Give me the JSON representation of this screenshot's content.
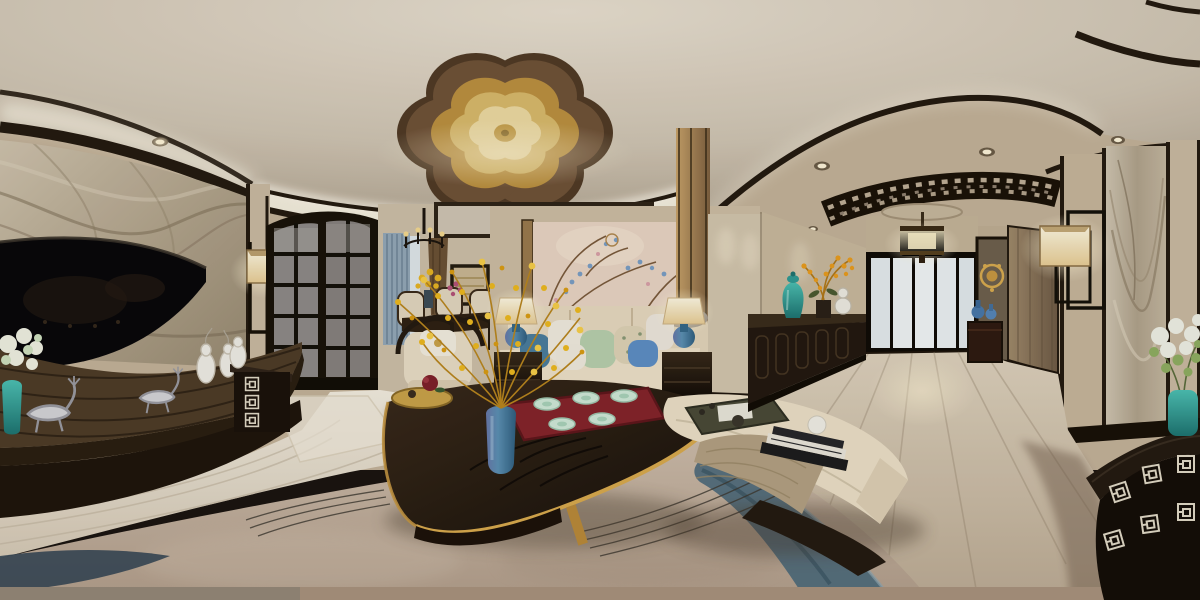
{
  "scene": {
    "type": "photograph",
    "projection": "equirectangular-360-panorama",
    "caption": "360-degree panoramic render of a luxury new-Chinese style living room, dining nook and entry hallway",
    "regions": [
      {
        "name": "tv-feature-wall",
        "description": "beige veined marble wall with large flat TV over a dark zebra-wood media console"
      },
      {
        "name": "living-area",
        "description": "cream sofa with pillows under a gold plum-blossom crystal chandelier, dark boat-shaped coffee table with yellow flowers and red tea tray"
      },
      {
        "name": "dining-nook",
        "description": "dark wood dining set with cream chairs, striped blue-grey curtains and small black chandelier"
      },
      {
        "name": "hallway",
        "description": "light wood floor corridor with black sideboard, frosted glass sliding doors, drum pendant and carved lattice ceiling band"
      },
      {
        "name": "right-wall",
        "description": "fabric wall panels, rectangular wall sconce, marble panel and black console with white fret pattern"
      }
    ],
    "objects": [
      {
        "name": "plum-blossom-chandelier",
        "color": "#c9a045"
      },
      {
        "name": "ceiling-cove-lighting",
        "color": "#f7f1e4"
      },
      {
        "name": "recessed-spotlights",
        "color": "#f4ead2"
      },
      {
        "name": "marble-feature-wall",
        "color": "#b9ab94"
      },
      {
        "name": "flat-tv",
        "color": "#08070a"
      },
      {
        "name": "media-console",
        "color": "#2e2114"
      },
      {
        "name": "silver-deer-figurines",
        "color": "#cfcfd2"
      },
      {
        "name": "white-gourd-vases",
        "color": "#efece6"
      },
      {
        "name": "hydrangea-in-teal-vase",
        "color": "#eef0e2"
      },
      {
        "name": "cube-wall-sconce-left",
        "color": "#f5ead0"
      },
      {
        "name": "fret-entry-cabinet",
        "color": "#1a110b"
      },
      {
        "name": "glass-partition-door",
        "color": "#8e8a88"
      },
      {
        "name": "striped-curtain",
        "color": "#93a7b8"
      },
      {
        "name": "brown-drape",
        "color": "#6b5136"
      },
      {
        "name": "dining-chandelier",
        "color": "#1c150e"
      },
      {
        "name": "abstract-wall-art",
        "color": "#c9b694"
      },
      {
        "name": "dining-table-and-chairs",
        "color": "#2e2014"
      },
      {
        "name": "barrel-armchair",
        "color": "#e8dcc6"
      },
      {
        "name": "floral-wallpaper-panel",
        "color": "#e8d4c4"
      },
      {
        "name": "cream-sofa",
        "color": "#e8dcc4"
      },
      {
        "name": "throw-pillows",
        "color": "#b7cfae"
      },
      {
        "name": "blue-ceramic-table-lamps",
        "color": "#3f7ea3"
      },
      {
        "name": "boat-shaped-coffee-table",
        "color": "#241a10"
      },
      {
        "name": "yellow-winter-jasmine",
        "color": "#ecb81f"
      },
      {
        "name": "blue-ceramic-vase",
        "color": "#4a7fa8"
      },
      {
        "name": "red-tea-tray-with-celadon-set",
        "color": "#84242b"
      },
      {
        "name": "upholstered-bench",
        "color": "#e9dcc4"
      },
      {
        "name": "tan-throw-blanket",
        "color": "#b3a083"
      },
      {
        "name": "stacked-books-and-ball",
        "color": "#e8e4da"
      },
      {
        "name": "green-tea-tray",
        "color": "#4a4a38"
      },
      {
        "name": "area-rug",
        "color": "#c2b09e"
      },
      {
        "name": "rug-blue-wave-pattern",
        "color": "#4e6a7c"
      },
      {
        "name": "hallway-sideboard",
        "color": "#221810"
      },
      {
        "name": "teal-temple-jar",
        "color": "#2f9a94"
      },
      {
        "name": "orange-orchid-arrangement",
        "color": "#e89c1e"
      },
      {
        "name": "frosted-sliding-doors",
        "color": "#e9eef1"
      },
      {
        "name": "drum-pendant-lamp",
        "color": "#f6e8bf"
      },
      {
        "name": "lattice-ceiling-band",
        "color": "#1a1208"
      },
      {
        "name": "gold-fan-ornament",
        "color": "#d8ab50"
      },
      {
        "name": "blue-gourd-vases",
        "color": "#4878aa"
      },
      {
        "name": "cube-wall-sconce-right",
        "color": "#f7ecd2"
      },
      {
        "name": "fret-pattern-console",
        "color": "#17100b"
      },
      {
        "name": "hardwood-floor",
        "color": "#e9e2d4"
      }
    ],
    "palette": {
      "ceiling": "#d8cfc0",
      "molding": "#241a10",
      "wall": "#c9b9a0",
      "marble": "#b9ab94",
      "floor_bright": "#ece6da",
      "floor_hall": "#cfc1ad",
      "carpet": "#c2b09e",
      "carpet_blue": "#4e6a7c",
      "sofa": "#e8dcc4",
      "accent_gold": "#c9a045",
      "accent_teal": "#2f9a94",
      "accent_blue": "#4a7fa8",
      "accent_red": "#84242b",
      "flower_yellow": "#e8b424"
    }
  }
}
